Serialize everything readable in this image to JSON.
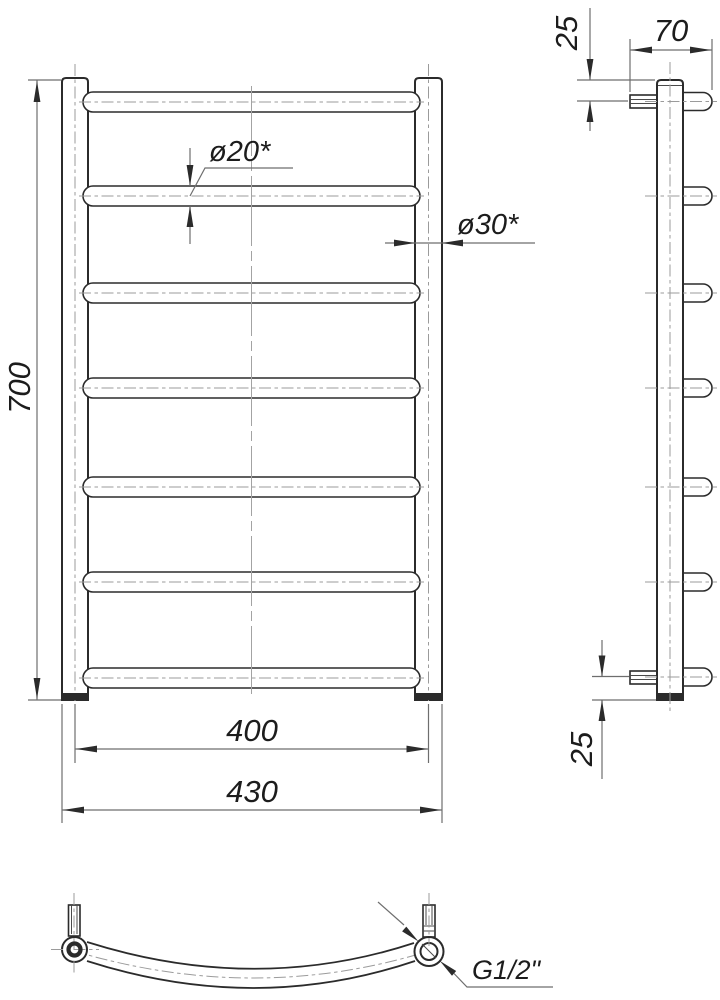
{
  "drawing": {
    "dimensions": {
      "height": "700",
      "inner_width": "400",
      "outer_width": "430",
      "rung_diameter": "ø20*",
      "rail_diameter": "ø30*",
      "depth": "70",
      "top_offset": "25",
      "bottom_offset": "25",
      "thread": "G1/2\""
    },
    "front_view": {
      "rung_count": 7
    },
    "colors": {
      "line": "#2b2b2b",
      "dim_line": "#6e6e6e",
      "centerline": "#9b9b9b",
      "background": "#ffffff"
    }
  }
}
